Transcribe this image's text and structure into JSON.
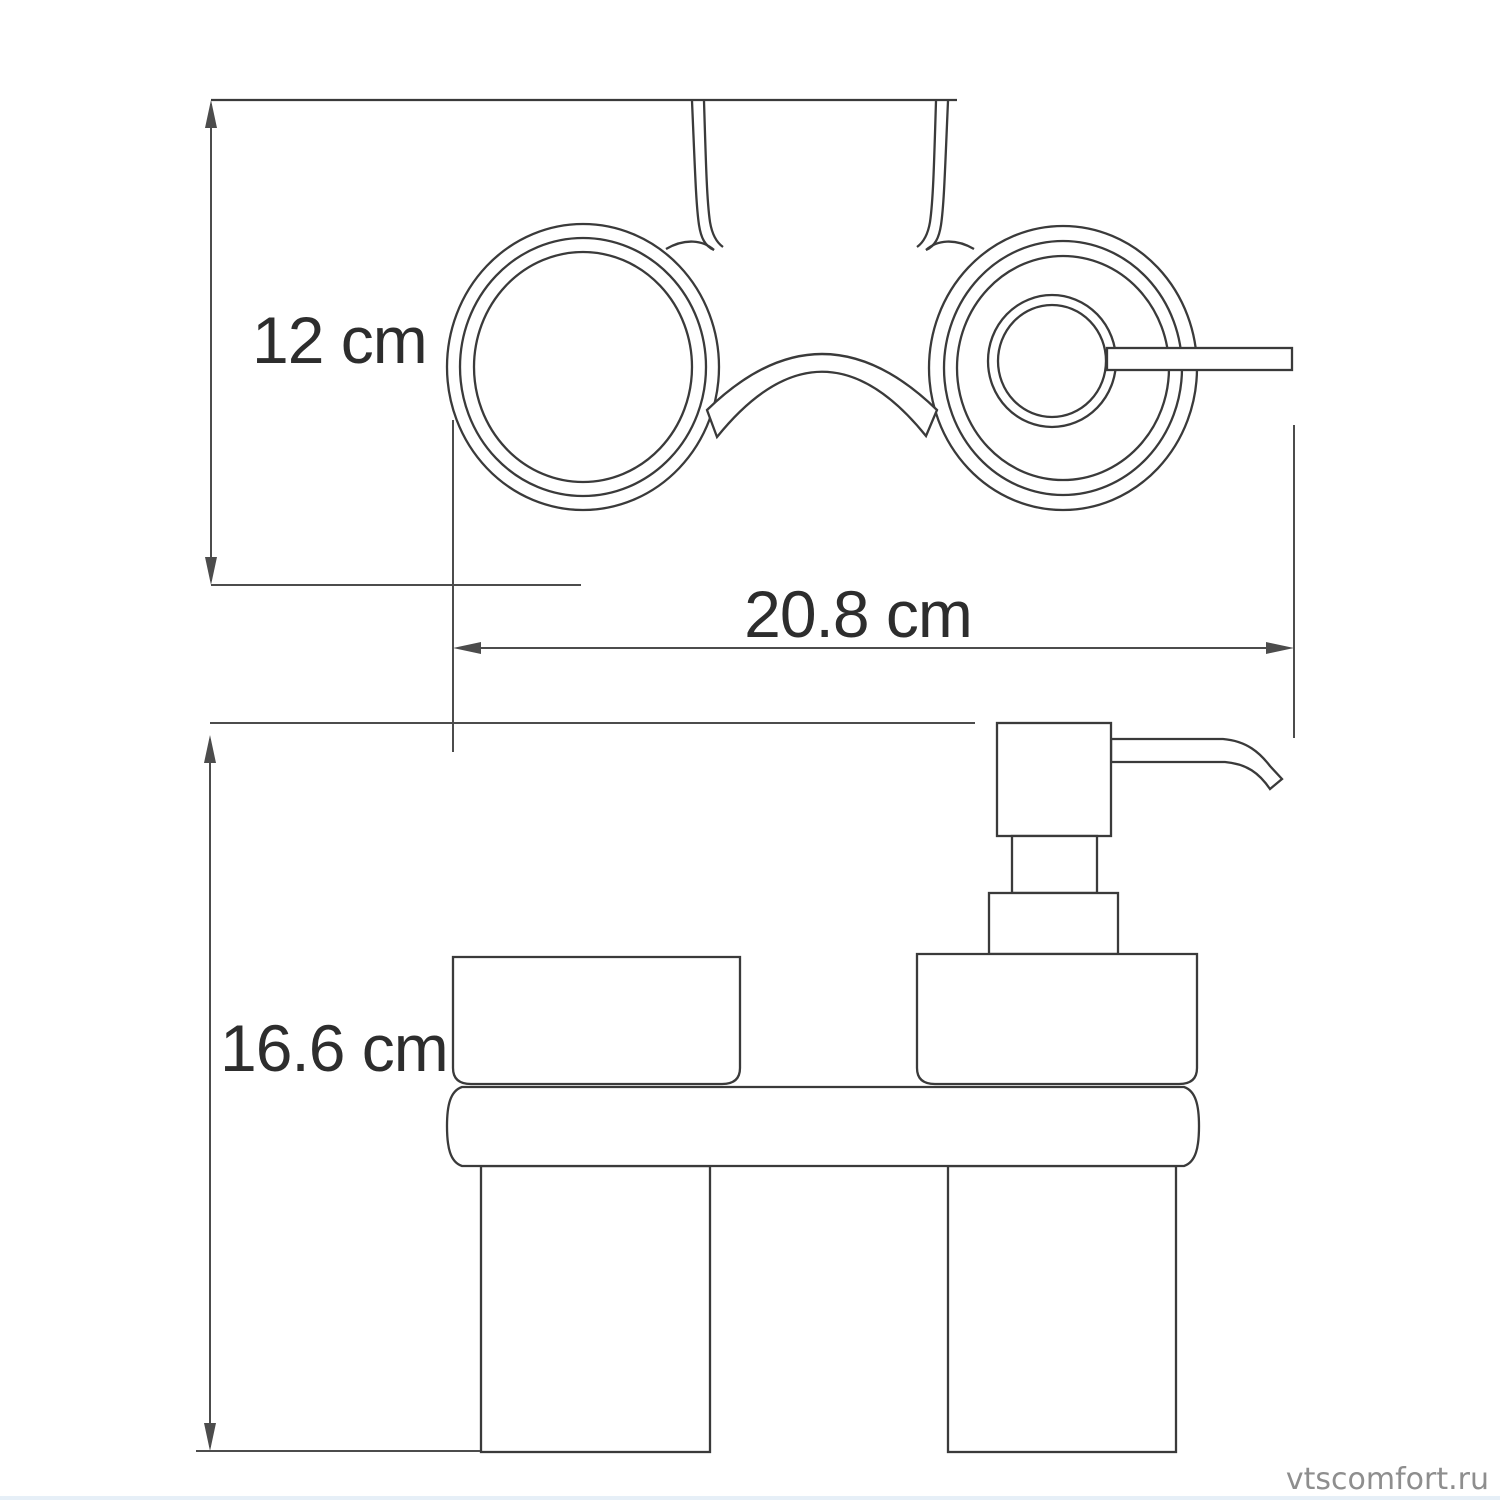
{
  "drawing": {
    "type": "technical-dimension-drawing",
    "subject": "wall-mounted double tumbler holder with soap dispenser (top view and front view)"
  },
  "dimensions": {
    "height_label": "12 cm",
    "width_label": "20.8 cm",
    "total_height_label": "16.6 cm"
  },
  "watermark": {
    "text": "vtscomfort.ru"
  },
  "colors": {
    "line": "#3a3a3a",
    "dim_line": "#4c4c4c",
    "text": "#2d2d2d",
    "watermark": "#8e8e8e",
    "background": "#ffffff",
    "bottom_strip": "#dce8f4"
  }
}
